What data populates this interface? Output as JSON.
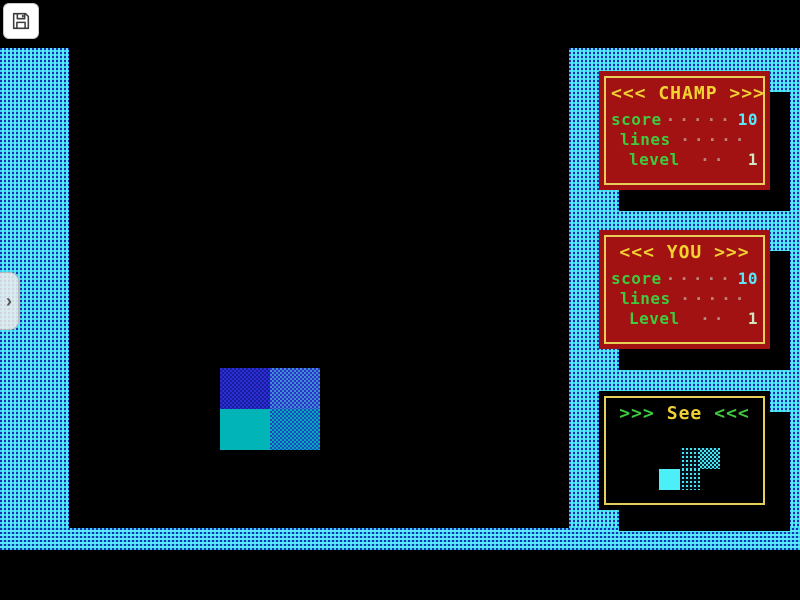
{
  "screen": {
    "type": "dos-tetris-game",
    "background": "#000000",
    "wall_pattern": {
      "name": "cyan-blue-dither",
      "cyan": "#59e8f8",
      "blue": "#1b2fb4"
    }
  },
  "toolbar": {
    "save_button": {
      "icon": "floppy-disk-icon",
      "label": "save screenshot"
    }
  },
  "drawer": {
    "chevron_glyph": "›"
  },
  "panels": {
    "champ": {
      "title": "<<< CHAMP >>>",
      "bg": "#a31212",
      "border": "#e8cf5a",
      "rows": [
        {
          "label": "score",
          "dots": "·····",
          "value": "10"
        },
        {
          "label": "lines",
          "dots": "·····",
          "value": ""
        },
        {
          "label": "level",
          "dots": "··",
          "value": "1"
        }
      ]
    },
    "you": {
      "title": "<<< YOU >>>",
      "bg": "#a31212",
      "border": "#e8cf5a",
      "rows": [
        {
          "label": "score",
          "dots": "·····",
          "value": "10"
        },
        {
          "label": "lines",
          "dots": "·····",
          "value": ""
        },
        {
          "label": "Level",
          "dots": "··",
          "value": "1"
        }
      ]
    },
    "next": {
      "title_prefix": ">>>",
      "title_word": "See",
      "title_suffix": "<<<",
      "piece": "S-piece cyan (one solid block, three dithered blocks)"
    }
  },
  "playfield": {
    "falling_piece": {
      "shape": "2x2 square",
      "top_row_color": "blue #2b2fd4 (dithered)",
      "bottom_row_color": "teal #00b4b8 (left solid, right dithered)"
    }
  },
  "colors": {
    "panel_red": "#a31212",
    "border_yellow": "#e8cf5a",
    "title_yellow": "#f2d233",
    "label_green": "#3ecb3e",
    "value_cyan": "#5ce6f6",
    "value_pale": "#cfe6c4",
    "piece_blue": "#2b2fd4",
    "piece_teal": "#00b4b8",
    "piece_cyan": "#4ceef8"
  }
}
